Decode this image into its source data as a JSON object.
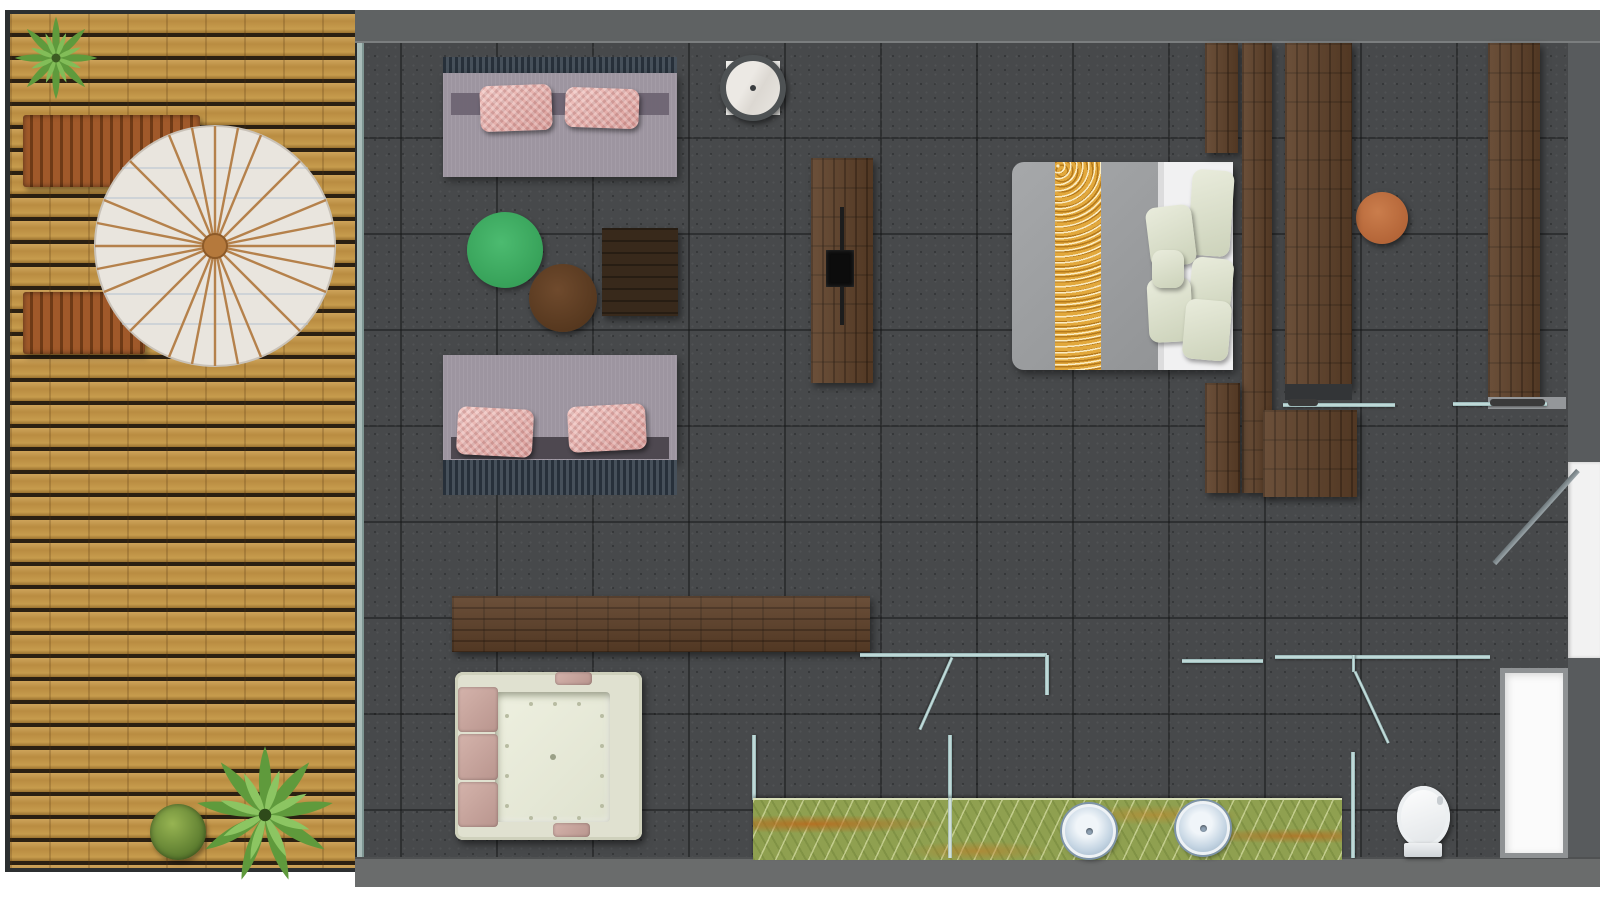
{
  "document": {
    "type": "floor-plan",
    "title": "Hotel suite floor plan — top view"
  },
  "palette": {
    "background": "#ffffff",
    "deck_wood": "#c2954a",
    "deck_gap": "#2b2012",
    "deck_border": "#2c2f30",
    "tile_floor": "#47494b",
    "tile_grout": "#363839",
    "wall_top": "#5f6263",
    "wall_bottom": "#6a6c6c",
    "wall_right": "#585b5d",
    "walnut_wood": "#5f4129",
    "dark_wood": "#38291b",
    "glass_partition": "#b9d6d6",
    "glass_wall": "#a9bcb9",
    "sofa_body": "#9d95a0",
    "sofa_pillow_pink": "#eec0bc",
    "sofa_band": "#39424b",
    "rug_green": "#3fae62",
    "ottoman_brown": "#5f3e26",
    "marble_white": "#e9e6e1",
    "bed_duvet": "#9c9ea0",
    "bed_runner_gold": "#e2a83c",
    "bed_sheet": "#f0f0f1",
    "bed_pillow": "#dfe3d0",
    "stool_terracotta": "#bf6f42",
    "jacuzzi_cream": "#e0e1d0",
    "jacuzzi_pad": "#c9a8a0",
    "vanity_onyx": "#8fa050",
    "sink_basin": "#c5d5e3",
    "toilet_white": "#f4f6f8",
    "niche_white": "#fbfbfb",
    "bench_rust": "#a0592a",
    "parasol_canvas": "#e9e5de",
    "parasol_spokes": "#b5814b",
    "plant_green": "#6fae45"
  },
  "areas": {
    "deck": {
      "label": "Outdoor wooden deck terrace"
    },
    "living": {
      "label": "Living / lounge area"
    },
    "bedroom": {
      "label": "Bedroom area"
    },
    "bathroom": {
      "label": "Bathroom and spa area"
    }
  },
  "furniture": {
    "plant_top": {
      "label": "Potted fern (deck, top-left)"
    },
    "plant_bottom": {
      "label": "Potted fern (deck, bottom)"
    },
    "shrub": {
      "label": "Round shrub (deck, bottom)"
    },
    "bench_upper": {
      "label": "Slatted deck bench (upper)"
    },
    "bench_lower": {
      "label": "Slatted deck bench (lower)"
    },
    "parasol": {
      "label": "Round parasol umbrella"
    },
    "sofa_upper": {
      "label": "Lounge sofa with two pink pillows (upper)"
    },
    "sofa_lower": {
      "label": "Lounge sofa with two pink pillows (lower)"
    },
    "marble_table": {
      "label": "Round marble side table"
    },
    "round_rug": {
      "label": "Round green rug"
    },
    "ottoman": {
      "label": "Round brown ottoman"
    },
    "side_table": {
      "label": "Square dark-wood coffee table"
    },
    "tv_panel": {
      "label": "Freestanding TV partition with wall-mounted TV"
    },
    "bed": {
      "label": "Double bed with gold runner and pillows"
    },
    "stool": {
      "label": "Round terracotta stool"
    },
    "wardrobe": {
      "label": "Walnut wardrobe columns"
    },
    "shelf_upper": {
      "label": "Glass shelf with rail (wardrobe)"
    },
    "shelf_right": {
      "label": "Glass shelf with rail (right wardrobe)"
    },
    "console": {
      "label": "Low walnut storage console"
    },
    "jacuzzi": {
      "label": "Built-in jacuzzi tub with head rests"
    },
    "vanity": {
      "label": "Green onyx vanity counter"
    },
    "sink_left": {
      "label": "Round basin (left)"
    },
    "sink_right": {
      "label": "Round basin (right)"
    },
    "toilet": {
      "label": "Toilet"
    },
    "niche": {
      "label": "Shower tray / niche"
    },
    "entry_door": {
      "label": "Entry door (right wall, open)"
    },
    "bath_door": {
      "label": "Glass swing door (bath)"
    },
    "wc_door": {
      "label": "Glass swing door (WC)"
    },
    "sliding_glass": {
      "label": "Sliding glass partition"
    }
  }
}
